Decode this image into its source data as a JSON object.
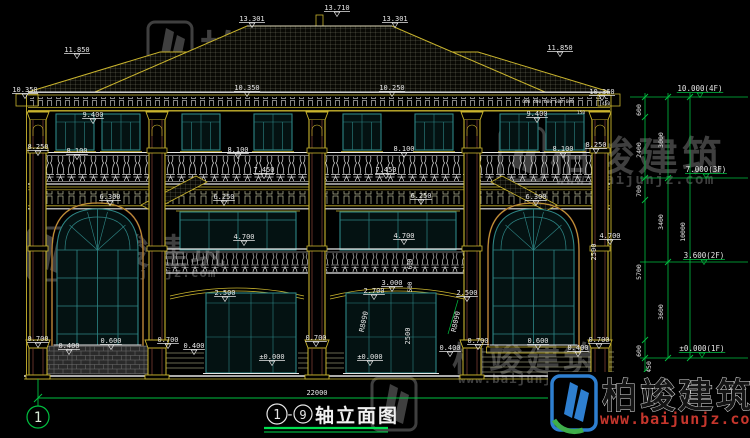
{
  "title": {
    "axis_start": "1",
    "dash": "-",
    "axis_end": "9",
    "text": "轴立面图",
    "full": "①-⑨轴立面图"
  },
  "grid_bubbles": {
    "left": "1",
    "right": "9"
  },
  "watermark": {
    "name": "柏竣建筑",
    "url": "www.baijunjz.com"
  },
  "floor_levels": [
    "10.000(4F)",
    "7.000(3F)",
    "3.600(2F)",
    "±0.000(1F)"
  ],
  "dimension_chains": {
    "right_inner_top_to_bottom": [
      "600",
      "2400",
      "700",
      "5700",
      "600",
      "450"
    ],
    "right_middle_top_to_bottom": [
      "3000",
      "3400",
      "3600"
    ],
    "right_overall": "10000",
    "bottom_overall": "22000"
  },
  "key_elevations": [
    "13.710",
    "13.301",
    "11.850",
    "10.360",
    "10.350",
    "10.250",
    "9.400",
    "8.250",
    "8.100",
    "7.450",
    "6.300",
    "6.250",
    "4.700",
    "3.000",
    "2.700",
    "2.500",
    "±0.000"
  ],
  "colors": {
    "background": "#000000",
    "line_yellow": "#c9b42e",
    "line_white": "#e6e6e6",
    "dim_green": "#00c040",
    "window_teal": "#2e8585",
    "accent_brown": "#8a4538",
    "watermark_gray": "#454545",
    "logo_blue": "#2e7fd0",
    "logo_green": "#3fae4a",
    "url_red": "#c5362c"
  },
  "annotations": [
    {
      "t": "13.301",
      "x": 252,
      "y": 21,
      "f": "w"
    },
    {
      "t": "13.710",
      "x": 337,
      "y": 10,
      "f": "w"
    },
    {
      "t": "13.301",
      "x": 395,
      "y": 21,
      "f": "w"
    },
    {
      "t": "11.850",
      "x": 77,
      "y": 52,
      "f": "w"
    },
    {
      "t": "11.850",
      "x": 560,
      "y": 50,
      "f": "w"
    },
    {
      "t": "10.350",
      "x": 25,
      "y": 92,
      "f": "w"
    },
    {
      "t": "10.350",
      "x": 247,
      "y": 90,
      "f": "w"
    },
    {
      "t": "10.250",
      "x": 392,
      "y": 90,
      "f": "w"
    },
    {
      "t": "10.360",
      "x": 602,
      "y": 94,
      "f": "w"
    },
    {
      "t": "9.400",
      "x": 93,
      "y": 117,
      "f": "w"
    },
    {
      "t": "9.400",
      "x": 537,
      "y": 116,
      "f": "w"
    },
    {
      "t": "600 600 600 600 600",
      "x": 548,
      "y": 103,
      "s": 4.5
    },
    {
      "t": "450",
      "x": 606,
      "y": 105,
      "s": 4.5
    },
    {
      "t": "150",
      "x": 581,
      "y": 114,
      "s": 4.5
    },
    {
      "t": "8.250",
      "x": 38,
      "y": 149,
      "f": "w"
    },
    {
      "t": "8.250",
      "x": 596,
      "y": 147,
      "f": "w"
    },
    {
      "t": "8.100",
      "x": 77,
      "y": 153,
      "f": "w"
    },
    {
      "t": "8.100",
      "x": 238,
      "y": 152,
      "f": "w"
    },
    {
      "t": "8.100",
      "x": 404,
      "y": 151,
      "f": "w"
    },
    {
      "t": "8.100",
      "x": 563,
      "y": 151,
      "f": "w"
    },
    {
      "t": "7.450",
      "x": 264,
      "y": 172,
      "f": "w"
    },
    {
      "t": "7.450",
      "x": 386,
      "y": 172,
      "f": "w"
    },
    {
      "t": "6.300",
      "x": 110,
      "y": 199,
      "f": "w"
    },
    {
      "t": "6.250",
      "x": 224,
      "y": 199,
      "f": "w"
    },
    {
      "t": "6.250",
      "x": 421,
      "y": 198,
      "f": "w"
    },
    {
      "t": "6.300",
      "x": 536,
      "y": 199,
      "f": "w"
    },
    {
      "t": "4.700",
      "x": 244,
      "y": 239,
      "f": "w"
    },
    {
      "t": "4.700",
      "x": 404,
      "y": 238,
      "f": "w"
    },
    {
      "t": "4.700",
      "x": 610,
      "y": 238,
      "f": "w"
    },
    {
      "t": "3.000",
      "x": 392,
      "y": 285,
      "f": "w"
    },
    {
      "t": "2.700",
      "x": 374,
      "y": 293,
      "f": "w"
    },
    {
      "t": "2.500",
      "x": 225,
      "y": 295,
      "f": "w"
    },
    {
      "t": "2.500",
      "x": 467,
      "y": 295,
      "f": "w"
    },
    {
      "t": "R8090",
      "x": 366,
      "y": 322,
      "r": -78
    },
    {
      "t": "R8090",
      "x": 458,
      "y": 322,
      "r": -78
    },
    {
      "t": "±0.000",
      "x": 272,
      "y": 359,
      "f": "w"
    },
    {
      "t": "±0.000",
      "x": 370,
      "y": 359,
      "f": "w"
    },
    {
      "t": "0.700",
      "x": 38,
      "y": 341,
      "f": "w"
    },
    {
      "t": "0.400",
      "x": 69,
      "y": 348,
      "f": "w"
    },
    {
      "t": "0.600",
      "x": 111,
      "y": 343,
      "f": "w"
    },
    {
      "t": "0.700",
      "x": 168,
      "y": 342,
      "f": "w"
    },
    {
      "t": "0.400",
      "x": 194,
      "y": 348,
      "f": "w"
    },
    {
      "t": "0.700",
      "x": 316,
      "y": 340,
      "f": "w"
    },
    {
      "t": "0.400",
      "x": 450,
      "y": 350,
      "f": "w"
    },
    {
      "t": "0.700",
      "x": 478,
      "y": 343,
      "f": "w"
    },
    {
      "t": "0.600",
      "x": 538,
      "y": 343,
      "f": "w"
    },
    {
      "t": "0.400",
      "x": 578,
      "y": 350,
      "f": "w"
    },
    {
      "t": "0.700",
      "x": 599,
      "y": 342,
      "f": "w"
    },
    {
      "t": "2500",
      "x": 410,
      "y": 336,
      "r": -90
    },
    {
      "t": "2500",
      "x": 596,
      "y": 252,
      "r": -90
    },
    {
      "t": "600",
      "x": 412,
      "y": 264,
      "r": -90,
      "s": 6
    },
    {
      "t": "500",
      "x": 412,
      "y": 287,
      "r": -90,
      "s": 6
    },
    {
      "t": "600",
      "x": 641,
      "y": 110,
      "r": -90,
      "s": 6.5
    },
    {
      "t": "2400",
      "x": 641,
      "y": 150,
      "r": -90,
      "s": 6.5
    },
    {
      "t": "700",
      "x": 641,
      "y": 191,
      "r": -90,
      "s": 6.5
    },
    {
      "t": "5700",
      "x": 641,
      "y": 272,
      "r": -90,
      "s": 6.5
    },
    {
      "t": "600",
      "x": 641,
      "y": 351,
      "r": -90,
      "s": 6.5
    },
    {
      "t": "450",
      "x": 651,
      "y": 367,
      "r": -90,
      "s": 6.5
    },
    {
      "t": "3000",
      "x": 663,
      "y": 140,
      "r": -90,
      "s": 6.5
    },
    {
      "t": "3400",
      "x": 663,
      "y": 222,
      "r": -90,
      "s": 6.5
    },
    {
      "t": "3600",
      "x": 663,
      "y": 312,
      "r": -90,
      "s": 6.5
    },
    {
      "t": "10000",
      "x": 685,
      "y": 232,
      "r": -90,
      "s": 6.5
    },
    {
      "t": "10.000(4F)",
      "x": 700,
      "y": 91,
      "s": 7.5,
      "f": "g"
    },
    {
      "t": "7.000(3F)",
      "x": 706,
      "y": 172,
      "s": 7.5,
      "f": "g"
    },
    {
      "t": "3.600(2F)",
      "x": 704,
      "y": 258,
      "s": 7.5,
      "f": "g"
    },
    {
      "t": "±0.000(1F)",
      "x": 702,
      "y": 351,
      "s": 7.5,
      "f": "g"
    },
    {
      "t": "22000",
      "x": 317,
      "y": 395
    }
  ]
}
